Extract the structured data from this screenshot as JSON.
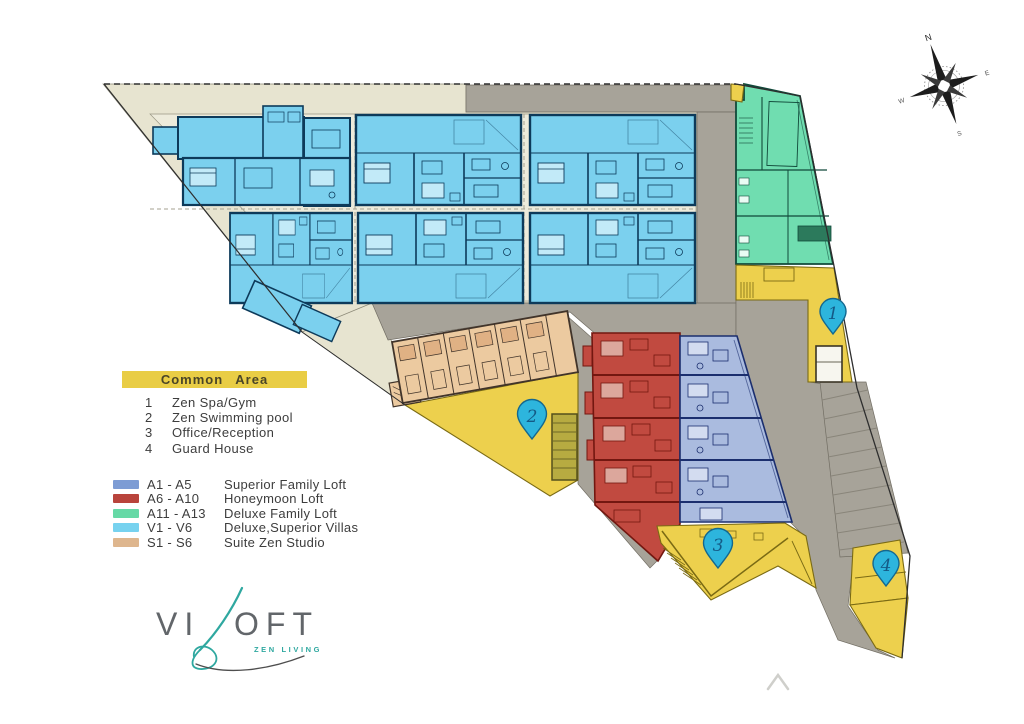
{
  "colors": {
    "site_beige": "#e7e4d0",
    "panel_beige": "#edebdb",
    "road_gray": "#a7a399",
    "road_edge": "#716d63",
    "villa_blue": "#7bd0ee",
    "villa_light": "#c2eaf8",
    "villa_wall": "#0d3a5a",
    "green_fill": "#70ddb0",
    "green_wall": "#11493a",
    "green_dark": "#2c7a5c",
    "area_yellow": "#edd04d",
    "yellow_line": "#7a6a14",
    "tan_fill": "#eccaa0",
    "tan_unit": "#e0b184",
    "tan_wall": "#41342a",
    "red_fill": "#c14a40",
    "red_light": "#dca79c",
    "red_wall": "#731710",
    "loft_blue": "#aabbdf",
    "loft_light": "#d3dcf0",
    "loft_wall": "#1b2e6e",
    "pool_olive": "#b7ab41",
    "pin_fill": "#2db5dd",
    "pin_edge": "#14688f",
    "pin_text": "#145a86",
    "boundary": "#2e2e2e",
    "bar_yellow": "#e9cd45",
    "legend_text": "#3d3d3d",
    "logo_gray": "#62666a",
    "logo_teal": "#2fa8a0"
  },
  "plan": {
    "markers": [
      {
        "num": "1",
        "label": "Zen Spa/Gym"
      },
      {
        "num": "2",
        "label": "Zen Swimming pool"
      },
      {
        "num": "3",
        "label": "Office/Reception"
      },
      {
        "num": "4",
        "label": "Guard House"
      }
    ],
    "compass": {
      "n": "N",
      "e": "E",
      "s": "S",
      "w": "W"
    }
  },
  "legend_common": {
    "title": "Common Area",
    "items": [
      {
        "num": "1",
        "label": "Zen Spa/Gym"
      },
      {
        "num": "2",
        "label": "Zen Swimming pool"
      },
      {
        "num": "3",
        "label": "Office/Reception"
      },
      {
        "num": "4",
        "label": "Guard House"
      }
    ]
  },
  "legend_units": {
    "items": [
      {
        "code": "A1 - A5",
        "label": "Superior Family Loft",
        "color": "#7d9cd4"
      },
      {
        "code": "A6 - A10",
        "label": "Honeymoon Loft",
        "color": "#b9443c"
      },
      {
        "code": "A11 - A13",
        "label": "Deluxe Family Loft",
        "color": "#66d9a6"
      },
      {
        "code": "V1 - V6",
        "label": "Deluxe,Superior Villas",
        "color": "#77d2ef"
      },
      {
        "code": "S1 - S6",
        "label": "Suite Zen Studio",
        "color": "#deb68e"
      }
    ]
  },
  "logo": {
    "prefix": "VI",
    "suffix": "OFT",
    "tagline": "ZEN LIVING"
  }
}
